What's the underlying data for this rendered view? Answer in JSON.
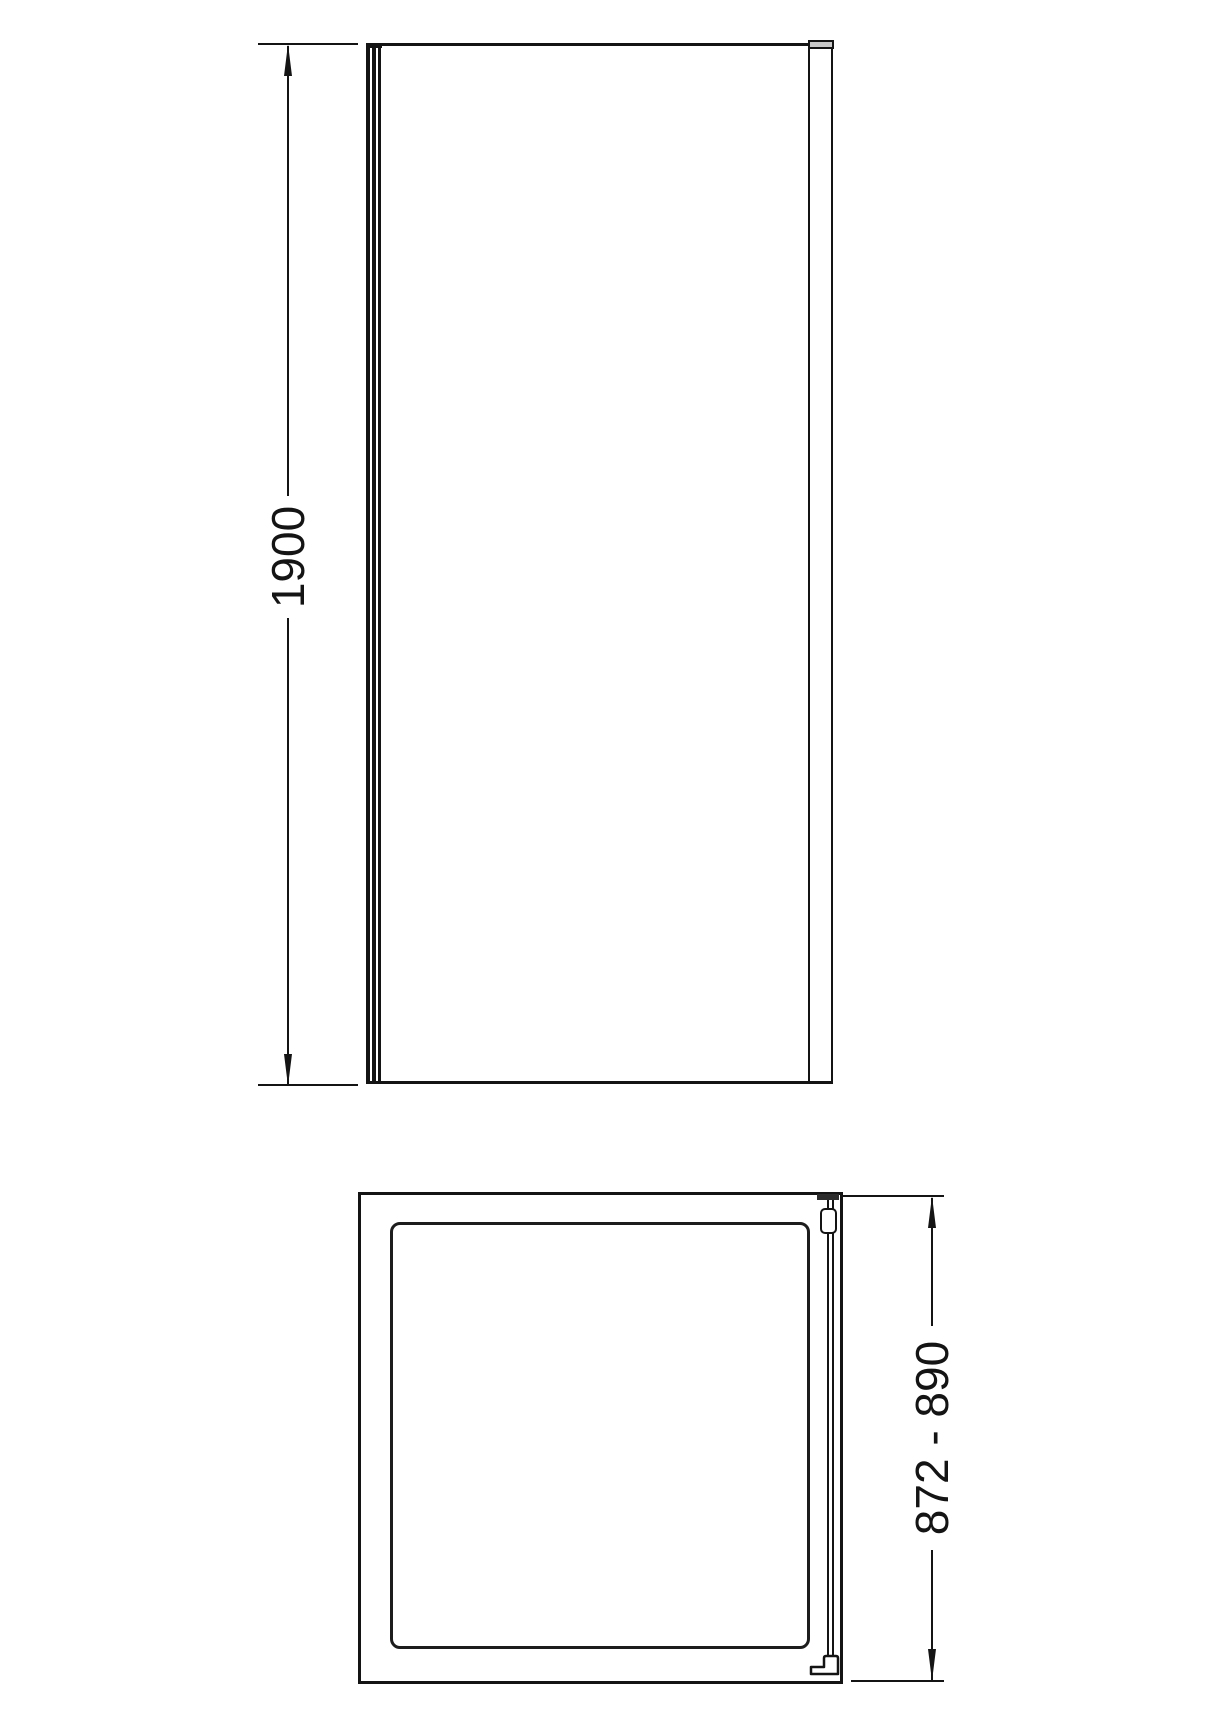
{
  "front_view": {
    "height_dimension": {
      "label": "1900"
    }
  },
  "plan_view": {
    "width_dimension": {
      "label": "872 - 890"
    }
  },
  "colors": {
    "line": "#141414",
    "profile_cap_fill": "#c9c9c9",
    "clamp_bar_fill": "#2b2b2b",
    "background": "#ffffff"
  }
}
